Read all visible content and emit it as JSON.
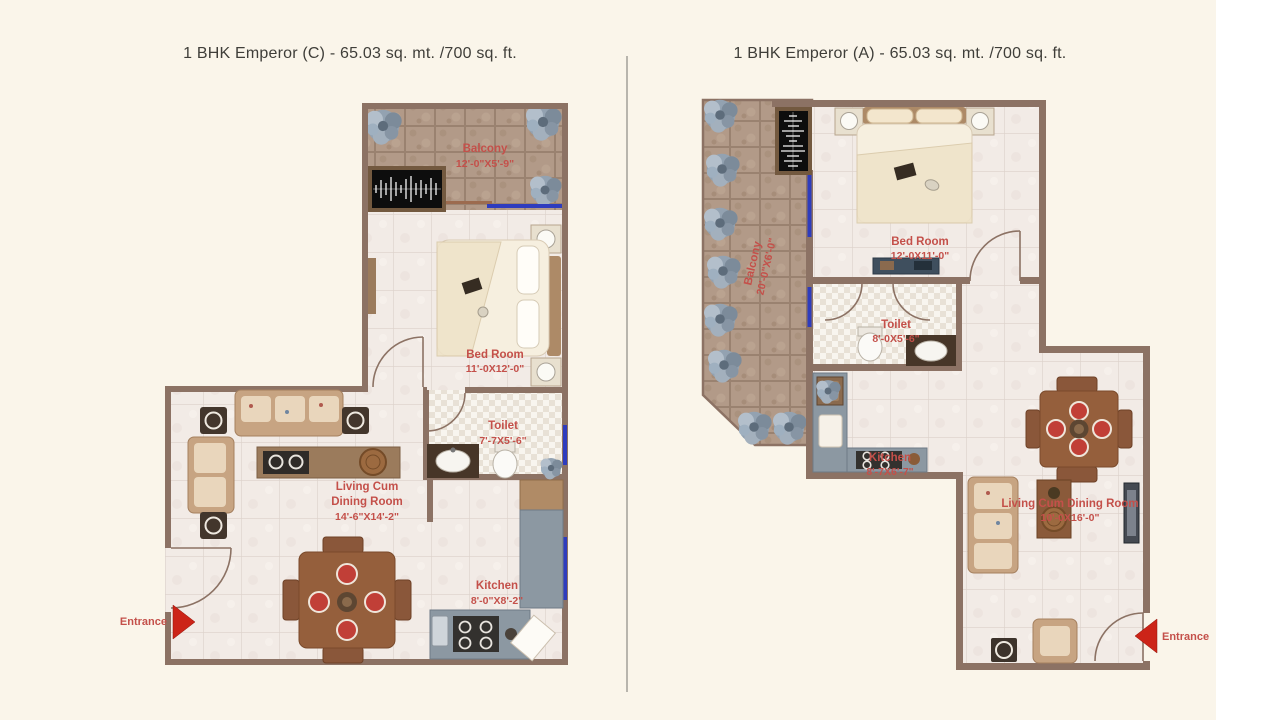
{
  "page": {
    "background_color": "#faf5ea",
    "divider_color": "#b8b5ad",
    "colors": {
      "wall": "#8c7264",
      "room_label": "#c4504a",
      "title_text": "#3f3e39",
      "window_blue": "#2e3cbe",
      "balcony_tile": "#b29a88",
      "floor_tile": "#f2ebe6",
      "counter_gray": "#8c98a2",
      "entrance_arrow": "#cc2418"
    }
  },
  "plans": [
    {
      "title": "1 BHK Emperor (C) - 65.03 sq. mt. /700 sq. ft.",
      "entrance_label": "Entrance",
      "rooms": {
        "balcony": {
          "name": "Balcony",
          "dims": "12'-0\"X5'-9\""
        },
        "bedroom": {
          "name": "Bed Room",
          "dims": "11'-0X12'-0\""
        },
        "toilet": {
          "name": "Toilet",
          "dims": "7'-7X5'-6\""
        },
        "living": {
          "line1": "Living Cum",
          "line2": "Dining Room",
          "dims": "14'-6\"X14'-2\""
        },
        "kitchen": {
          "name": "Kitchen",
          "dims": "8'-0\"X8'-2\""
        }
      }
    },
    {
      "title": "1 BHK Emperor (A) - 65.03 sq. mt. /700 sq. ft.",
      "entrance_label": "Entrance",
      "rooms": {
        "balcony": {
          "name": "Balcony",
          "dims": "20'-0\"X6'-0\""
        },
        "bedroom": {
          "name": "Bed Room",
          "dims": "12'-0X11'-0\""
        },
        "toilet": {
          "name": "Toilet",
          "dims": "8'-0X5'-6\""
        },
        "kitchen": {
          "name": "Kitchen",
          "dims": "8'-7X6'-7\""
        },
        "living": {
          "name": "Living Cum Dining Room",
          "dims": "10'-0X16'-0\""
        }
      }
    }
  ]
}
